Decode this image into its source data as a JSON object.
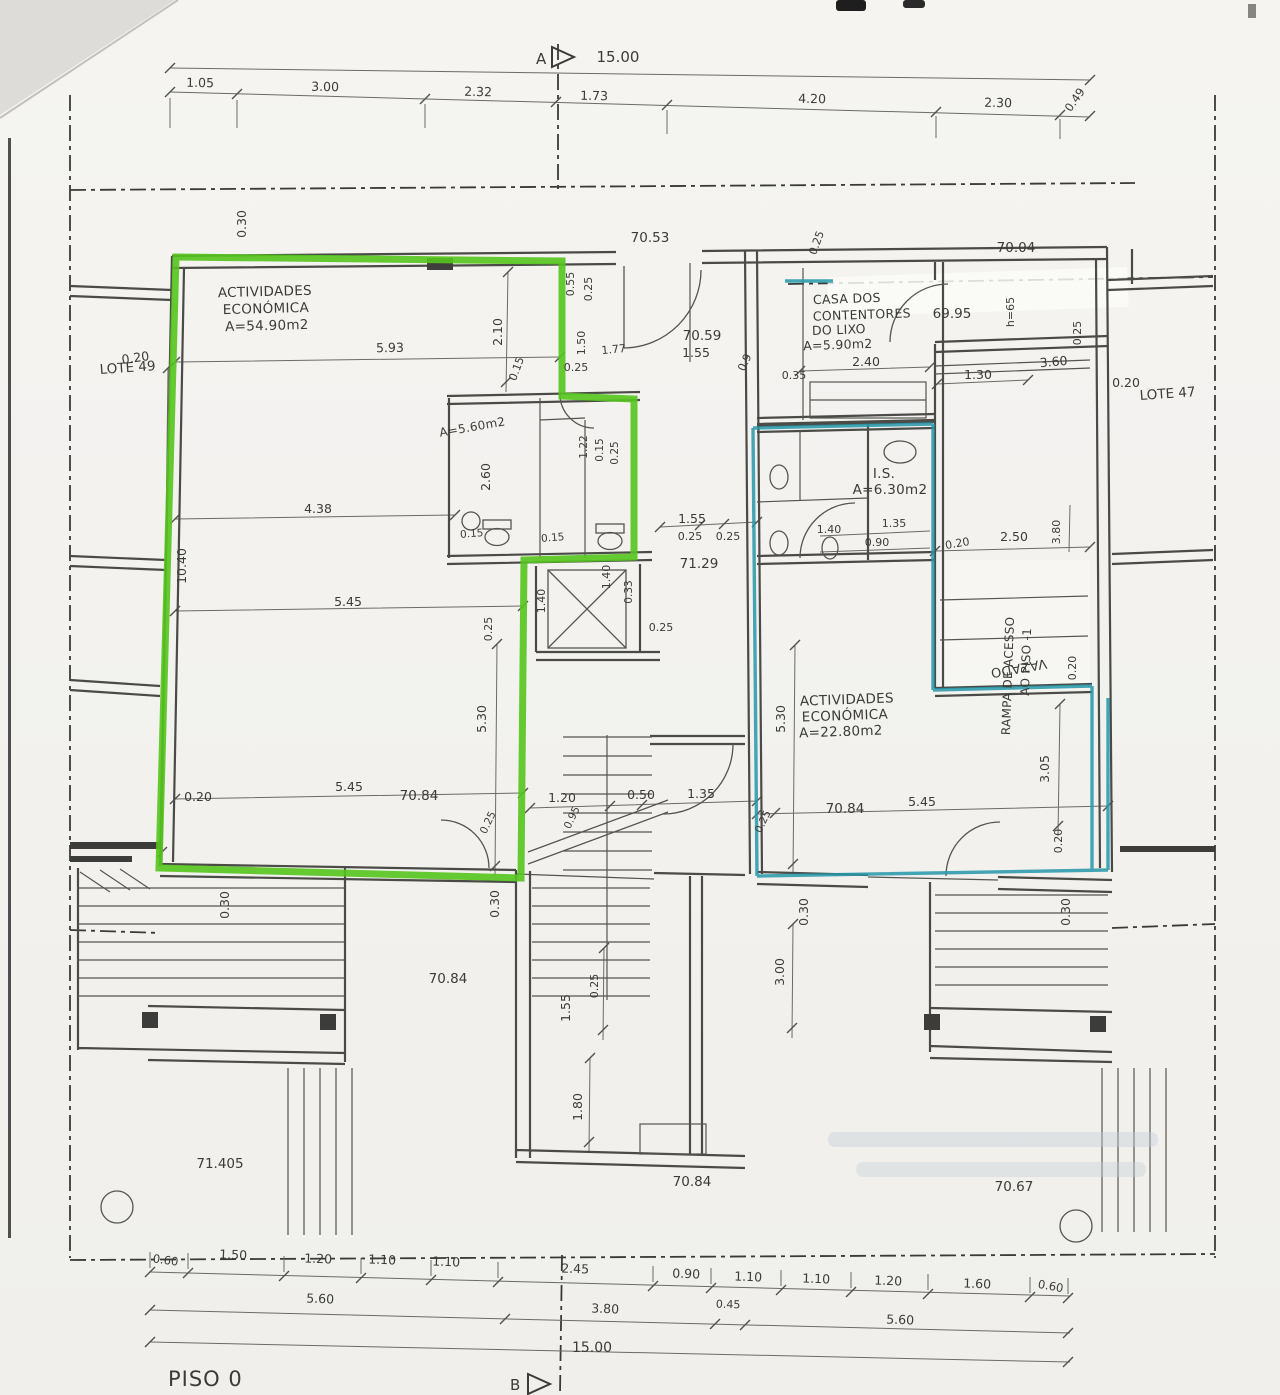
{
  "floor": "PISO 0",
  "markers": {
    "a": "A",
    "b": "B"
  },
  "lots": {
    "left": "LOTE 49",
    "right": "LOTE 47"
  },
  "chains": {
    "top": [
      "1.05",
      "3.00",
      "2.32",
      "1.73",
      "4.20",
      "2.30",
      "0.49"
    ],
    "top_total": "15.00",
    "bottom": [
      "0.60",
      "1.50",
      "1.20",
      "1.10",
      "1.10",
      "2.45",
      "0.90",
      "1.10",
      "1.10",
      "1.20",
      "1.60",
      "0.60"
    ],
    "bottom_row2": [
      "5.60",
      "3.80",
      "0.45",
      "5.60"
    ],
    "bottom_total": "15.00"
  },
  "levels": {
    "a": "70.53",
    "b": "70.04",
    "c": "69.95",
    "d": "70.59",
    "e": "71.29",
    "f": "70.84",
    "g": "70.84",
    "h": "70.84",
    "i": "70.84",
    "j": "71.405",
    "k": "70.67"
  },
  "rooms": {
    "left_unit": [
      "ACTIVIDADES",
      "ECONÓMICA",
      "A=54.90m2"
    ],
    "right_unit": [
      "ACTIVIDADES",
      "ECONÓMICA",
      "A=22.80m2"
    ],
    "trash_room": [
      "CASA DOS",
      "CONTENTORES",
      "DO LIXO",
      "A=5.90m2"
    ],
    "wc_left": "A=5.60m2",
    "is_room": [
      "I.S.",
      "A=6.30m2"
    ],
    "ramp": [
      "RAMPA DE ACESSO",
      "AO PISO -1"
    ],
    "void": "VAZADO"
  },
  "dims": [
    "0.30",
    "5.93",
    "2.10",
    "0.15",
    "0.55",
    "0.25",
    "1.50",
    "1.77",
    "0.25",
    "1.55",
    "0.9",
    "0.25",
    "2.40",
    "0.35",
    "1.30",
    "0.25",
    "3.60",
    "h=65",
    "0.20",
    "0.20",
    "2.60",
    "1.22",
    "0.15",
    "0.25",
    "0.15",
    "0.15",
    "4.38",
    "10.40",
    "5.45",
    "0.25",
    "0.25",
    "1.55",
    "0.25",
    "0.25",
    "1.40",
    "0.33",
    "1.40",
    "5.30",
    "5.30",
    "1.20",
    "0.50",
    "1.35",
    "0.95",
    "0.20",
    "5.45",
    "0.25",
    "0.30",
    "0.30",
    "0.25",
    "5.45",
    "3.05",
    "0.20",
    "0.30",
    "0.30",
    "3.00",
    "1.55",
    "0.25",
    "1.80",
    "2.50",
    "3.80",
    "0.20",
    "0.20",
    "1.35",
    "0.90",
    "1.40"
  ],
  "colors": {
    "highlight_left": "#55c41d",
    "highlight_right": "#2596a8",
    "ink": "#4a4a47"
  }
}
